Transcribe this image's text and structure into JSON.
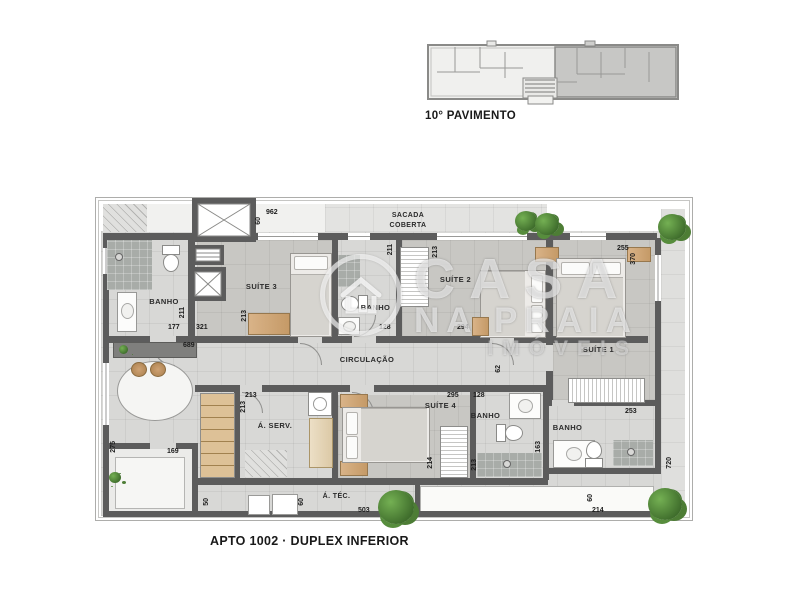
{
  "header": {
    "key_plan_label": "10° PAVIMENTO"
  },
  "footer": {
    "title": "APTO 1002 · DUPLEX INFERIOR"
  },
  "watermark": {
    "line1": "CASA",
    "line2": "NA PRAIA",
    "line3": "IMÓVEIS"
  },
  "rooms": {
    "sacada1": "SACADA",
    "sacada2": "COBERTA",
    "banho1": "BANHO",
    "suite3": "SUÍTE 3",
    "banho2": "BANHO",
    "suite2": "SUÍTE 2",
    "suite1": "SUÍTE 1",
    "circ": "CIRCULAÇÃO",
    "aserv": "Á. SERV.",
    "suite4": "SUÍTE 4",
    "banho3": "BANHO",
    "banho4": "BANHO",
    "atec": "Á. TÉC."
  },
  "dims": {
    "d962": "962",
    "d60a": "60",
    "d177": "177",
    "d211a": "211",
    "d321": "321",
    "d213a": "213",
    "d689": "689",
    "d211b": "211",
    "d128a": "128",
    "d213b": "213",
    "d294": "294",
    "d255": "255",
    "d370": "370",
    "d62": "62",
    "d213c": "213",
    "d213d": "213",
    "d295": "295",
    "d128b": "128",
    "d214a": "214",
    "d213e": "213",
    "d253": "253",
    "d163": "163",
    "d275": "275",
    "d169": "169",
    "d50": "50",
    "d60b": "60",
    "d503": "503",
    "d60c": "60",
    "d214b": "214",
    "d720": "720"
  },
  "colors": {
    "wall": "#5c5c5c",
    "floor": "#d8d8d6",
    "suite_floor": "#c8c7c3",
    "wood": "#d0a976",
    "plant_green": "#4d7d35"
  }
}
